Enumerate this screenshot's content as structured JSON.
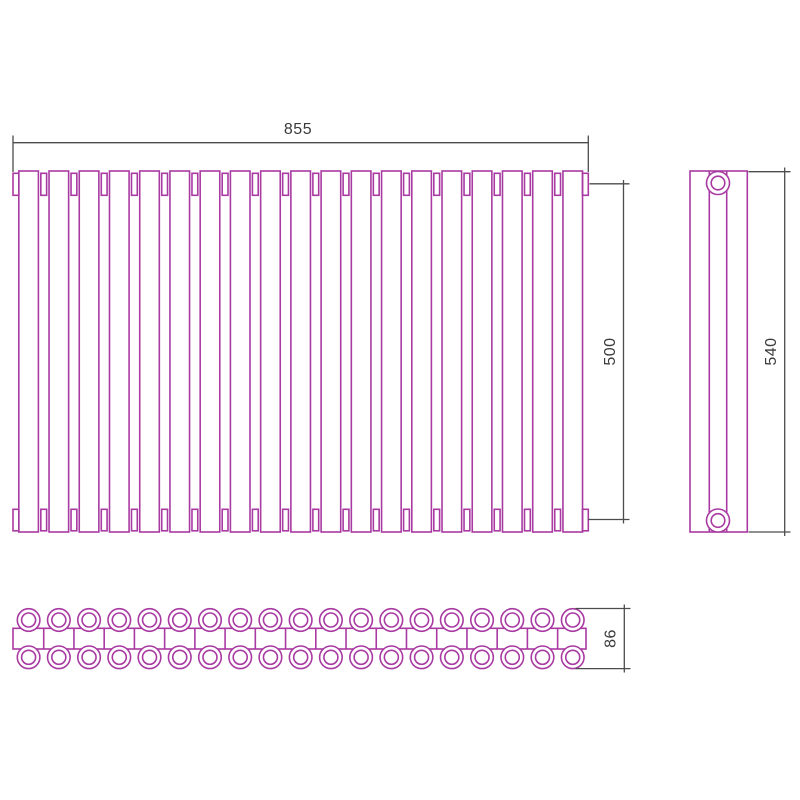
{
  "drawing": {
    "kind": "technical-drawing",
    "subject": "sectional tube radiator, three orthographic views",
    "dims": {
      "width": "855",
      "axis_spacing": "500",
      "height": "540",
      "depth": "86"
    },
    "front_view": {
      "tube_count": 19,
      "top_connector_count": 18,
      "bottom_connector_count": 18,
      "end_cap_count": 2
    },
    "side_view": {
      "fitting_count": 2
    },
    "bottom_view": {
      "column_count": 19,
      "row_count": 2,
      "divider_count": 18
    },
    "colors": {
      "outline": "#A83AA2",
      "dimension": "#4C4C4C",
      "label": "#3A3A3A",
      "background": "#FFFFFF"
    }
  }
}
